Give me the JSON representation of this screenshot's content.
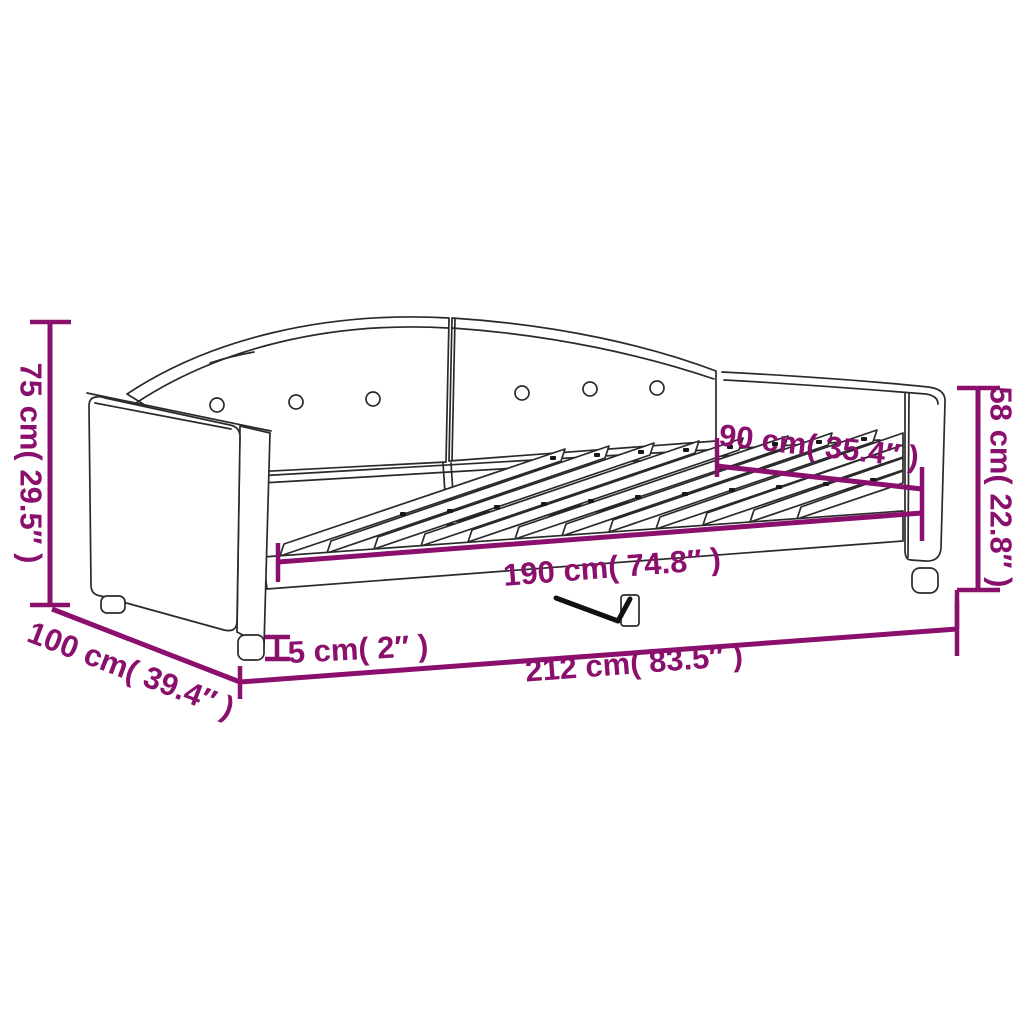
{
  "diagram": {
    "subject": "daybed-dimension-line-drawing",
    "colors": {
      "dimension_accent": "#8B106D",
      "line_art": "#2A2A2A",
      "background": "#FFFFFF"
    },
    "labels": {
      "height_left": "75 cm( 29.5″ )",
      "depth": "100 cm( 39.4″ )",
      "length_overall": "212 cm( 83.5″ )",
      "leg_height": "5 cm( 2″ )",
      "sleeping_length": "190 cm( 74.8″ )",
      "width": "90 cm( 35.4″ )",
      "height_right": "58 cm( 22.8″ )"
    }
  }
}
